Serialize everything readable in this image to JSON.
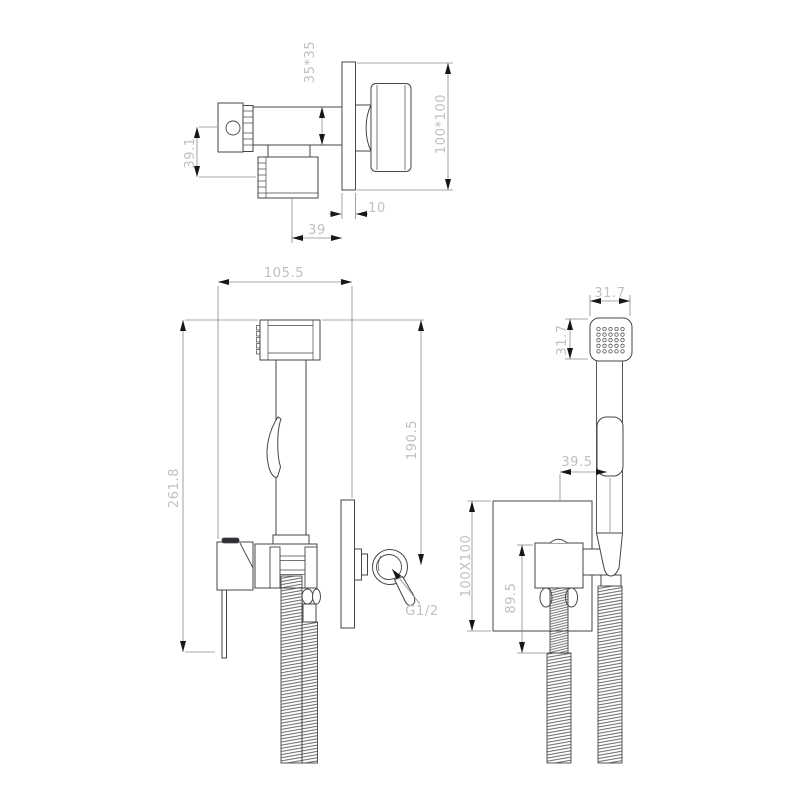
{
  "drawing": {
    "type": "technical-dimension-drawing",
    "subject": "concealed bidet hand shower set",
    "colors": {
      "line": "#45454a",
      "dim_line": "#8b8b8b",
      "dim_text": "#bdc1c1",
      "arrow": "#17171a",
      "cap": "#2f2f33",
      "background": "#ffffff"
    },
    "views": {
      "valve_top": {
        "dims": {
          "spout_section": "35*35",
          "outlet_offset": "39.1",
          "plate_thickness": "10",
          "valve_depth": "39",
          "wall_plate": "100*100"
        }
      },
      "assembly_profile": {
        "dims": {
          "overall_width": "105.5",
          "overall_height": "261.8",
          "handset_height": "190.5",
          "connection_thread": "G1/2"
        }
      },
      "assembly_front": {
        "dims": {
          "head_width": "31.7",
          "head_depth": "31.7",
          "handset_offset": "39.5",
          "wall_plate": "100X100",
          "valve_drop": "89.5"
        }
      }
    }
  }
}
